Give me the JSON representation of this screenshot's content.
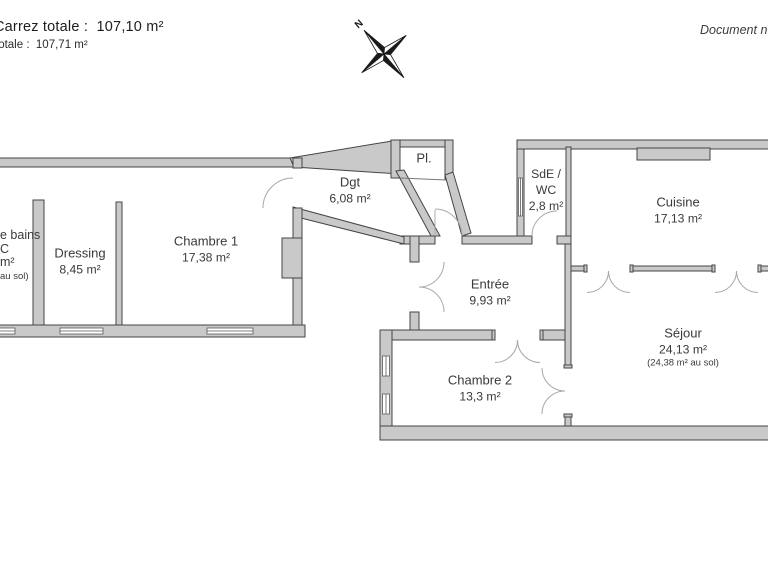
{
  "header": {
    "carrez_total": "Carrez totale :  107,10 m²",
    "surface_total": "totale :  107,71 m²"
  },
  "document_note": "Document n",
  "compass": {
    "north": "N"
  },
  "rooms": {
    "chambre1": {
      "name": "Chambre 1",
      "area": "17,38 m²"
    },
    "dressing": {
      "name": "Dressing",
      "area": "8,45 m²"
    },
    "salle_de_bains_partial": {
      "line1": "e bains",
      "line2": "C",
      "line3": "m²",
      "line4": "au sol)"
    },
    "dgt": {
      "name": "Dgt",
      "area": "6,08 m²"
    },
    "placard": {
      "name": "Pl."
    },
    "sde_wc": {
      "line1": "SdE /",
      "line2": "WC",
      "line3": "2,8 m²"
    },
    "cuisine": {
      "name": "Cuisine",
      "area": "17,13 m²"
    },
    "entree": {
      "name": "Entrée",
      "area": "9,93 m²"
    },
    "chambre2": {
      "name": "Chambre 2",
      "area": "13,3 m²"
    },
    "sejour": {
      "name": "Séjour",
      "area": "24,13 m²",
      "area_floor": "(24,38 m² au sol)"
    }
  },
  "colors": {
    "wall_fill": "#c9c9c9",
    "wall_stroke": "#454545",
    "door_stroke": "#a8a8a8",
    "text": "#3a3a3a"
  }
}
